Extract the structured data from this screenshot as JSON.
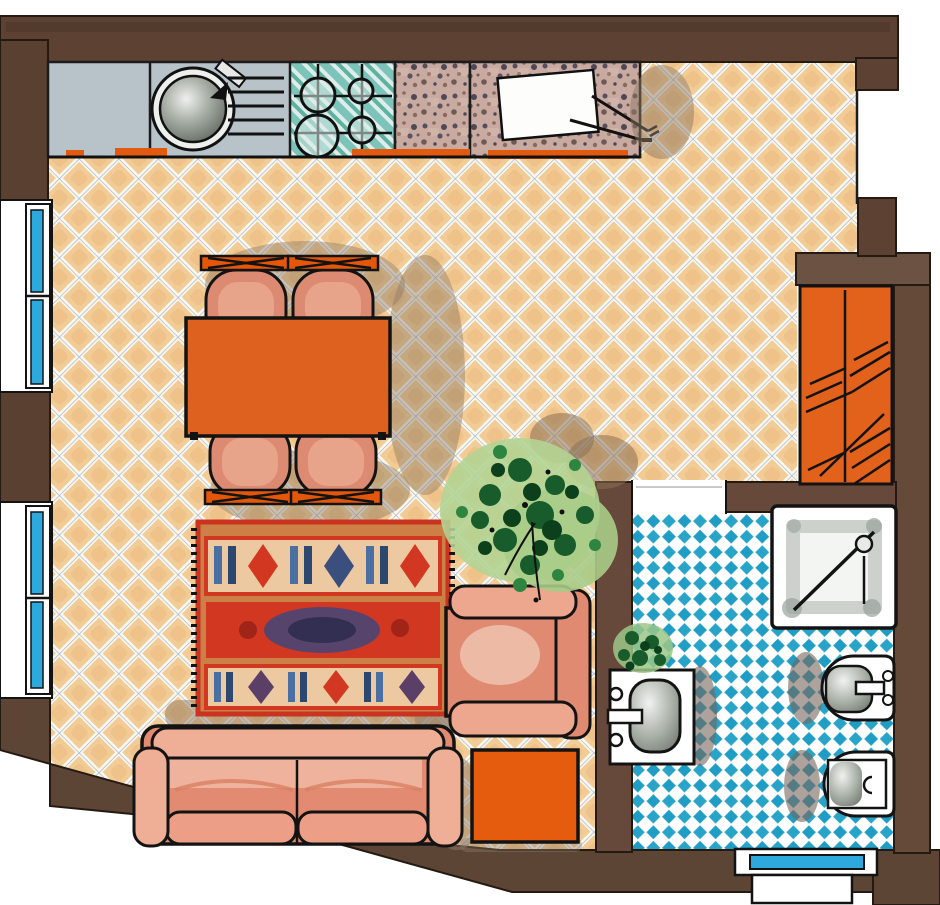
{
  "drawing": {
    "kind": "hand-drawn apartment floor plan, top view, marker/watercolor style",
    "rooms": [
      "kitchen-living-dining-room",
      "bathroom",
      "wardrobe-niche"
    ],
    "palette": {
      "wall_brown": "#5d4233",
      "wall_brown_light": "#66493a",
      "floor_tile_tan": "#f2cc97",
      "floor_grout": "#fdf8ee",
      "floor_grid_line": "#aabcd0",
      "bathroom_tile_blue": "#28a4c8",
      "window_glass_blue": "#2da9dd",
      "counter_gray": "#b7c2c9",
      "hob_teal": "#7cc4ba",
      "speckle_counter": "#c9aaa0",
      "accent_orange": "#e2611b",
      "furniture_salmon": "#e08a72",
      "rug_ground": "#cc8045",
      "rug_red": "#d23821",
      "rug_blue": "#4a6fa3",
      "plant_green_dark": "#175c2a",
      "plant_green_light": "#b3d494",
      "fixture_gray": "#8b928a",
      "shadow_brown": "#8f7a64"
    },
    "items": [
      {
        "id": "kitchen-counter",
        "parts": [
          "worktop",
          "sink-basin",
          "tap",
          "drainboard",
          "hob-4-burners",
          "speckled-worktop",
          "cutting-board",
          "knife-and-fork"
        ]
      },
      {
        "id": "dining-set",
        "parts": [
          "orange-table",
          "chair-top-left",
          "chair-top-right",
          "chair-bottom-left",
          "chair-bottom-right"
        ]
      },
      {
        "id": "area-rug",
        "style": "red-blue patterned kilim with fringes"
      },
      {
        "id": "sofa",
        "seats": 2
      },
      {
        "id": "armchair"
      },
      {
        "id": "side-table-orange"
      },
      {
        "id": "plant-large"
      },
      {
        "id": "plant-small"
      },
      {
        "id": "wardrobe",
        "style": "orange, hanging rod with clothes hatches"
      },
      {
        "id": "shower"
      },
      {
        "id": "washbasin"
      },
      {
        "id": "bidet"
      },
      {
        "id": "toilet"
      },
      {
        "id": "windows-left",
        "count": 4
      },
      {
        "id": "window-bathroom",
        "count": 1
      },
      {
        "id": "door-opening-bathroom"
      }
    ]
  }
}
